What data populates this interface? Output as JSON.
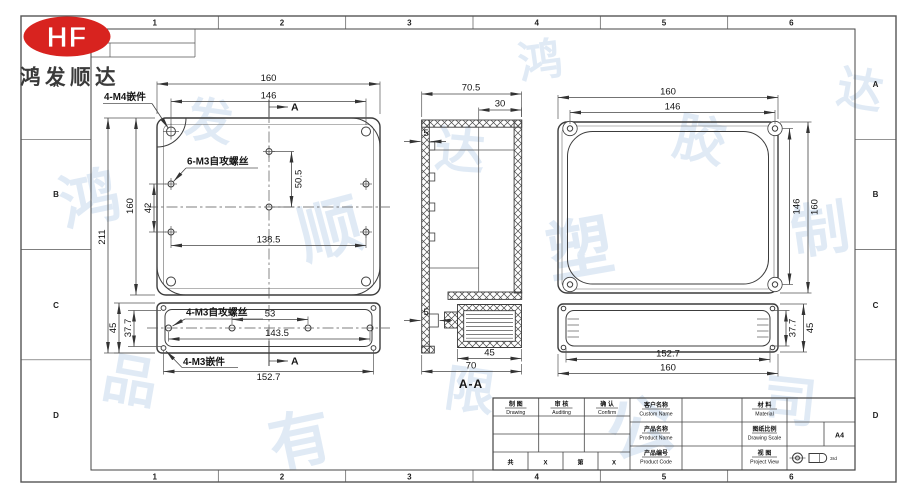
{
  "page": {
    "company_name": "鸿发顺达",
    "logo_text": "HF"
  },
  "zones": {
    "top": [
      "1",
      "2",
      "3",
      "4",
      "5",
      "6"
    ],
    "bottom": [
      "1",
      "2",
      "3",
      "4",
      "5",
      "6"
    ],
    "left": [
      "A",
      "B",
      "C",
      "D"
    ],
    "right": [
      "A",
      "B",
      "C",
      "D"
    ]
  },
  "watermark": {
    "chars": [
      "鸿",
      "发",
      "顺",
      "达",
      "塑",
      "胶",
      "制",
      "品",
      "有",
      "限",
      "公",
      "司",
      "鸿",
      "达"
    ]
  },
  "base_view": {
    "dim_width": "160",
    "dim_width_inner": "146",
    "dim_height_total": "211",
    "dim_height": "160",
    "dim_hole_gap": "42",
    "dim_hole_v": "50.5",
    "dim_hole_span": "138.5",
    "label_insert": "4-M4嵌件",
    "label_screw": "6-M3自攻螺丝",
    "section_marker_top": "A",
    "section_marker_bottom": "A"
  },
  "base_lid_view": {
    "dim_height": "45",
    "dim_height_inner": "37.7",
    "dim_hole_gap": "53",
    "dim_hole_span": "143.5",
    "dim_width": "152.7",
    "label_screw": "4-M3自攻螺丝",
    "label_insert": "4-M3嵌件"
  },
  "section_view": {
    "dim_width": "70.5",
    "dim_offset": "30",
    "dim_wall_top": "5",
    "dim_wall_bottom": "5",
    "dim_lid": "45",
    "dim_depth": "70",
    "title": "A-A"
  },
  "cover_view": {
    "dim_width": "160",
    "dim_width_inner": "146",
    "dim_height": "160",
    "dim_height_inner": "146"
  },
  "cover_side_view": {
    "dim_height_inner": "37.7",
    "dim_height": "45",
    "dim_width_inner": "152.7",
    "dim_width": "160"
  },
  "title_block": {
    "drawing_cn": "制 图",
    "drawing_en": "Drawing",
    "auditing_cn": "审 核",
    "auditing_en": "Auditing",
    "confirm_cn": "确 认",
    "confirm_en": "Confirm",
    "customer_cn": "客户名称",
    "customer_en": "Custom Name",
    "product_name_cn": "产品名称",
    "product_name_en": "Product Name",
    "product_code_cn": "产品编号",
    "product_code_en": "Product Code",
    "material_cn": "材 料",
    "material_en": "Material",
    "scale_cn": "图纸比例",
    "scale_en": "Drawing Scale",
    "view_cn": "视 图",
    "view_en": "Project View",
    "paper_size": "A4",
    "projection_note": "3rd",
    "sheet_cells": [
      "共",
      "X",
      "第",
      "X"
    ]
  },
  "colors": {
    "logo_red": "#d8231f",
    "line": "#3f3f3f",
    "watermark": "#c3d7ec"
  }
}
